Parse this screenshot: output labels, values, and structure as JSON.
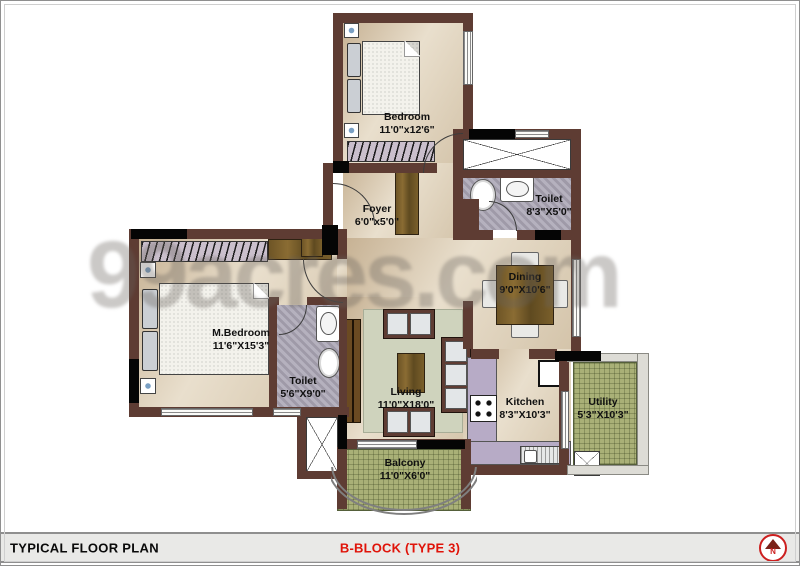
{
  "watermark": "99acres.com",
  "footer": {
    "left_title": "TYPICAL FLOOR PLAN",
    "center_title": "B-BLOCK (TYPE 3)",
    "north_label": "N"
  },
  "colors": {
    "wall": "#5e3c33",
    "accent_red": "#e01309",
    "floor_beige": "#dccfb9",
    "wet_floor_gray": "#aba6b5",
    "tile_green": "#a9b077"
  },
  "rooms": [
    {
      "name": "Bedroom",
      "dims": "11'0\"x12'6\""
    },
    {
      "name": "Toilet",
      "dims": "8'3\"X5'0\""
    },
    {
      "name": "Foyer",
      "dims": "6'0\"x5'0\""
    },
    {
      "name": "Dining",
      "dims": "9'0\"X10'6\""
    },
    {
      "name": "M.Bedroom",
      "dims": "11'6\"X15'3\""
    },
    {
      "name": "Toilet",
      "dims": "5'6\"X9'0\""
    },
    {
      "name": "Living",
      "dims": "11'0\"X18'0\""
    },
    {
      "name": "Kitchen",
      "dims": "8'3\"X10'3\""
    },
    {
      "name": "Utility",
      "dims": "5'3\"X10'3\""
    },
    {
      "name": "Balcony",
      "dims": "11'0\"X6'0\""
    }
  ]
}
